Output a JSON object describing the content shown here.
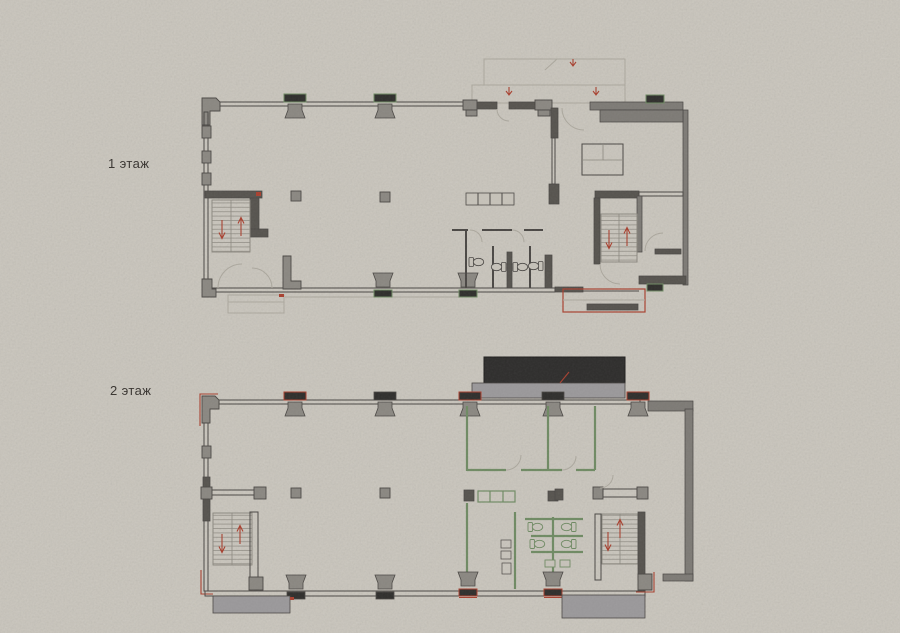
{
  "floors": [
    {
      "label": "1 этаж"
    },
    {
      "label": "2 этаж"
    }
  ],
  "colors": {
    "paper": "#c8c4bb",
    "ink": "#4a4744",
    "wall_dark": "#56534e",
    "wall_mid": "#7d7a75",
    "column_fill": "#8a8781",
    "cap_dark": "#2f2e2c",
    "green": "#6f8a63",
    "red": "#a8402f",
    "faint": "#aba79d",
    "stair": "#8b887f",
    "canopy_dark": "#2e2d2c",
    "canopy_gray": "#9a989a"
  }
}
